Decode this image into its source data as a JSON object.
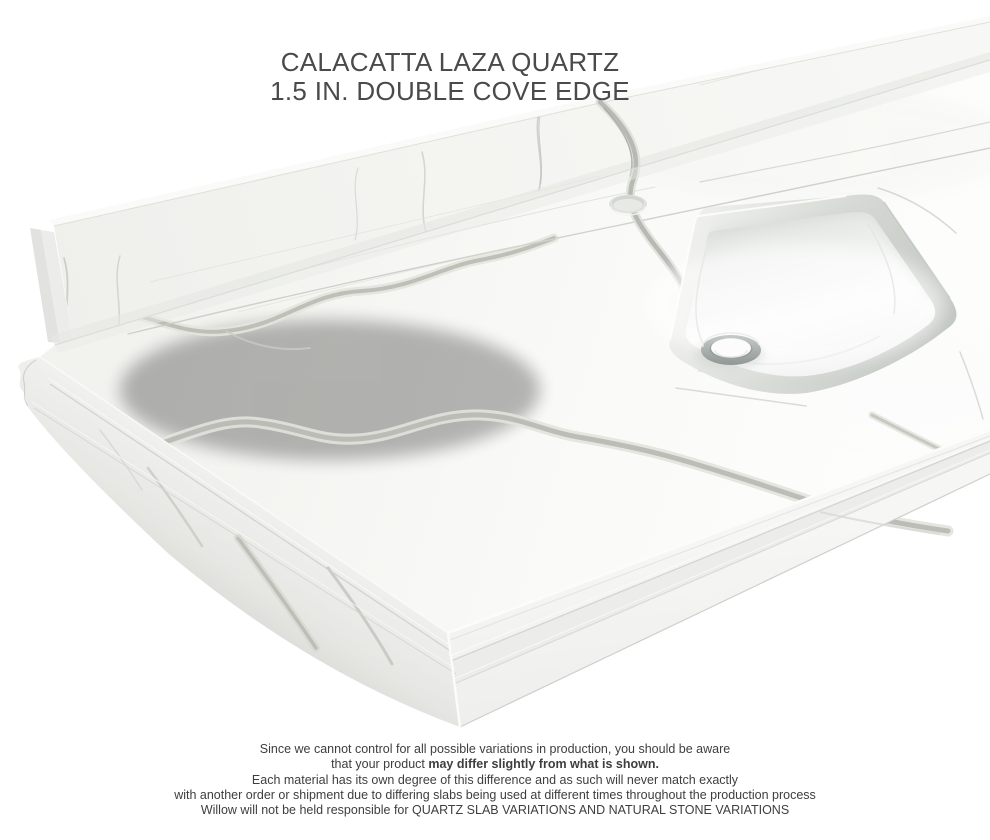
{
  "header": {
    "title_line1": "CALACATTA LAZA QUARTZ",
    "title_line2": "1.5 IN. DOUBLE COVE EDGE",
    "title_color": "#4a4a4a"
  },
  "disclaimer": {
    "line1": "Since we cannot control for all possible variations in production, you should be aware",
    "line2_normal": "that your product ",
    "line2_bold": "may differ slightly from what is shown.",
    "line3": "Each material has its own degree of this difference and as such will never match exactly",
    "line4": "with another order or shipment due to differing slabs being used at different times throughout the production process",
    "line5": "Willow will not be held responsible for QUARTZ SLAB VARIATIONS AND NATURAL STONE VARIATIONS",
    "text_color": "#3e3e3e"
  },
  "scene": {
    "background_color": "#ffffff",
    "quartz_surface_color": "#f7f7f5",
    "vein_color": "#b7b9b2",
    "sink_rim_color": "#ccd0cb",
    "basin_color": "#ffffff",
    "drain_color": "#a8aeac"
  }
}
